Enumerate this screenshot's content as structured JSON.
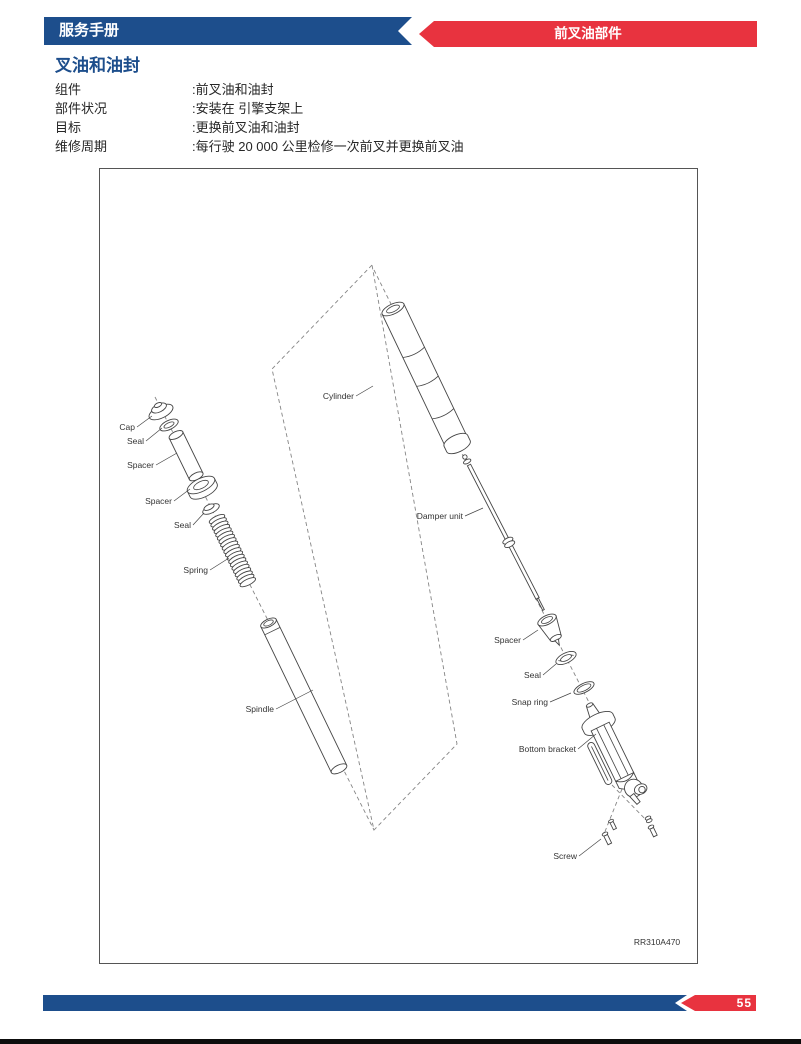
{
  "colors": {
    "header_blue": "#1d4e8c",
    "banner_red": "#e8333f",
    "title_blue": "#1d4e8c",
    "text_dark": "#262626"
  },
  "header": {
    "left_banner": "服务手册",
    "right_banner": "前叉油部件"
  },
  "page": {
    "title": "叉油和油封"
  },
  "info": {
    "rows": [
      {
        "label": "组件",
        "value": ":前叉油和油封"
      },
      {
        "label": "部件状况",
        "value": ":安装在 引擎支架上"
      },
      {
        "label": "目标",
        "value": ":更换前叉油和油封"
      },
      {
        "label": "维修周期",
        "value": ":每行驶 20 000 公里检修一次前叉并更换前叉油"
      }
    ]
  },
  "diagram": {
    "labels": {
      "cap": "Cap",
      "seal_upper": "Seal",
      "spacer_tube": "Spacer",
      "spacer_ring": "Spacer",
      "seal_mid": "Seal",
      "spring": "Spring",
      "spindle": "Spindle",
      "cylinder": "Cylinder",
      "damper_unit": "Damper unit",
      "spacer_lower": "Spacer",
      "seal_lower": "Seal",
      "snap_ring": "Snap ring",
      "bottom_bracket": "Bottom bracket",
      "screw": "Screw"
    },
    "ref_code": "RR310A470"
  },
  "footer": {
    "page_number": "55"
  }
}
